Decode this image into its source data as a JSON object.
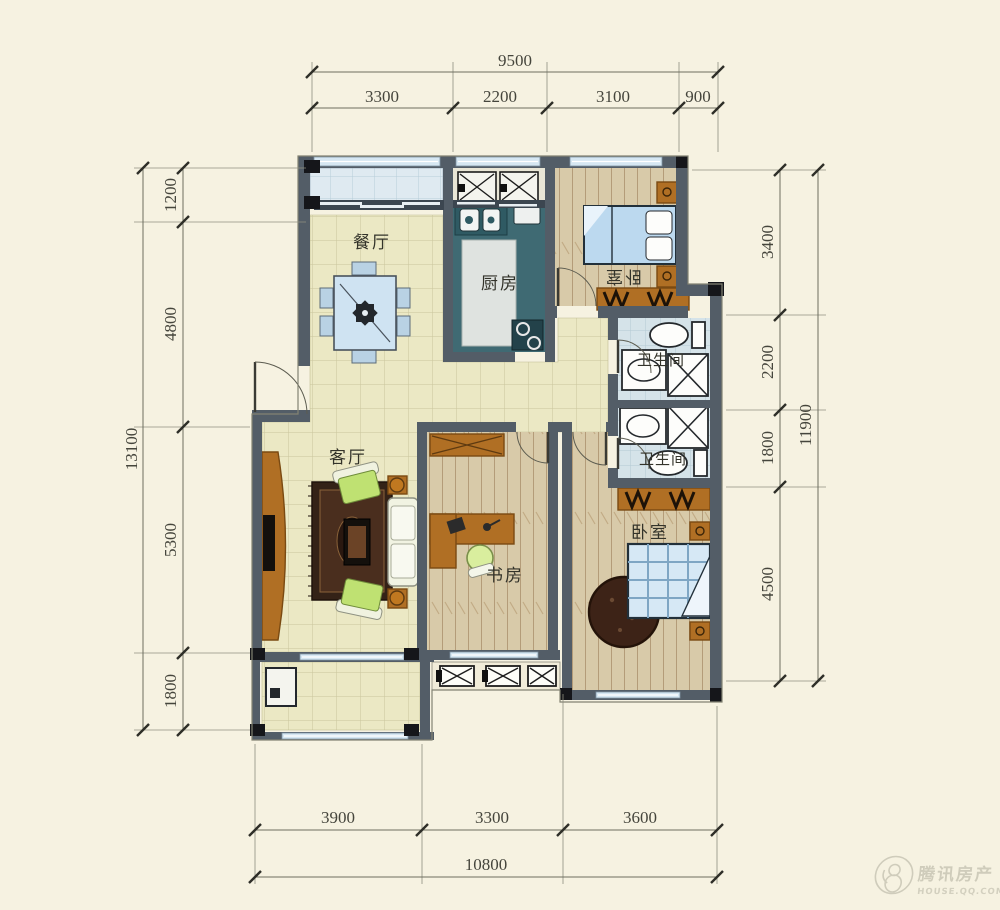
{
  "rooms": {
    "dining": {
      "label": "餐厅"
    },
    "kitchen": {
      "label": "厨房"
    },
    "bedroom_top": {
      "label": "卧室"
    },
    "bathroom_top": {
      "label": "卫生间"
    },
    "bathroom_bottom": {
      "label": "卫生间"
    },
    "living": {
      "label": "客厅"
    },
    "study": {
      "label": "书房"
    },
    "bedroom_bottom": {
      "label": "卧室"
    }
  },
  "dimensions": {
    "top": {
      "total": "9500",
      "segments": [
        "3300",
        "2200",
        "3100",
        "900"
      ]
    },
    "left": {
      "total": "13100",
      "segments": [
        "1200",
        "4800",
        "5300",
        "1800"
      ]
    },
    "right": {
      "total": "11900",
      "segments": [
        "3400",
        "2200",
        "1800",
        "4500"
      ]
    },
    "bottom": {
      "total": "10800",
      "segments": [
        "3900",
        "3300",
        "3600"
      ]
    }
  },
  "watermark": {
    "brand": "腾讯房产",
    "site": "HOUSE.QQ.COM"
  },
  "colors": {
    "background": "#f6f2e1",
    "wall": "#535d67",
    "floor_public": "#ebe8c4",
    "floor_wood": "#d7c9a8",
    "floor_bath": "#d5e3e9",
    "floor_balcony": "#dfeaf1",
    "kitchen_counter": "#3f6a73",
    "furniture_wood": "#b06f24",
    "dimension_text": "#45453c"
  }
}
